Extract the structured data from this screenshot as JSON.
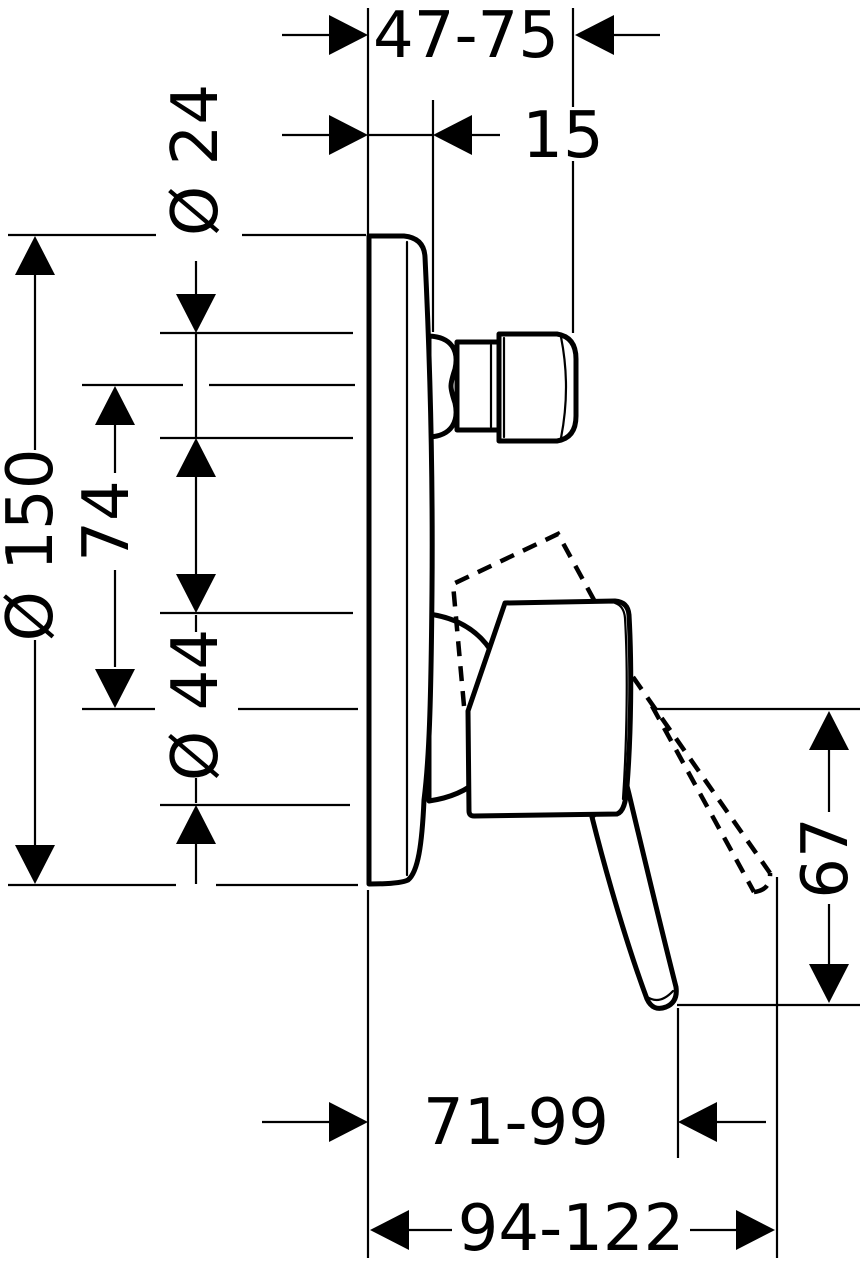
{
  "diagram": {
    "type": "technical dimension drawing",
    "subject": "concealed single-lever mixer, side elevation",
    "colors": {
      "line": "#000000",
      "background": "#ffffff"
    },
    "dimensions": {
      "wall_to_spout_end": "47-75",
      "plate_thickness": "15",
      "spout_connection_diameter": "Ø 24",
      "escutcheon_diameter": "Ø 150",
      "spout_axis_to_handle_axis": "74",
      "handle_hub_diameter": "Ø 44",
      "handle_axis_to_lever_end": "67",
      "wall_to_lever_end": "71-99",
      "wall_to_lever_end_open": "94-122"
    }
  }
}
